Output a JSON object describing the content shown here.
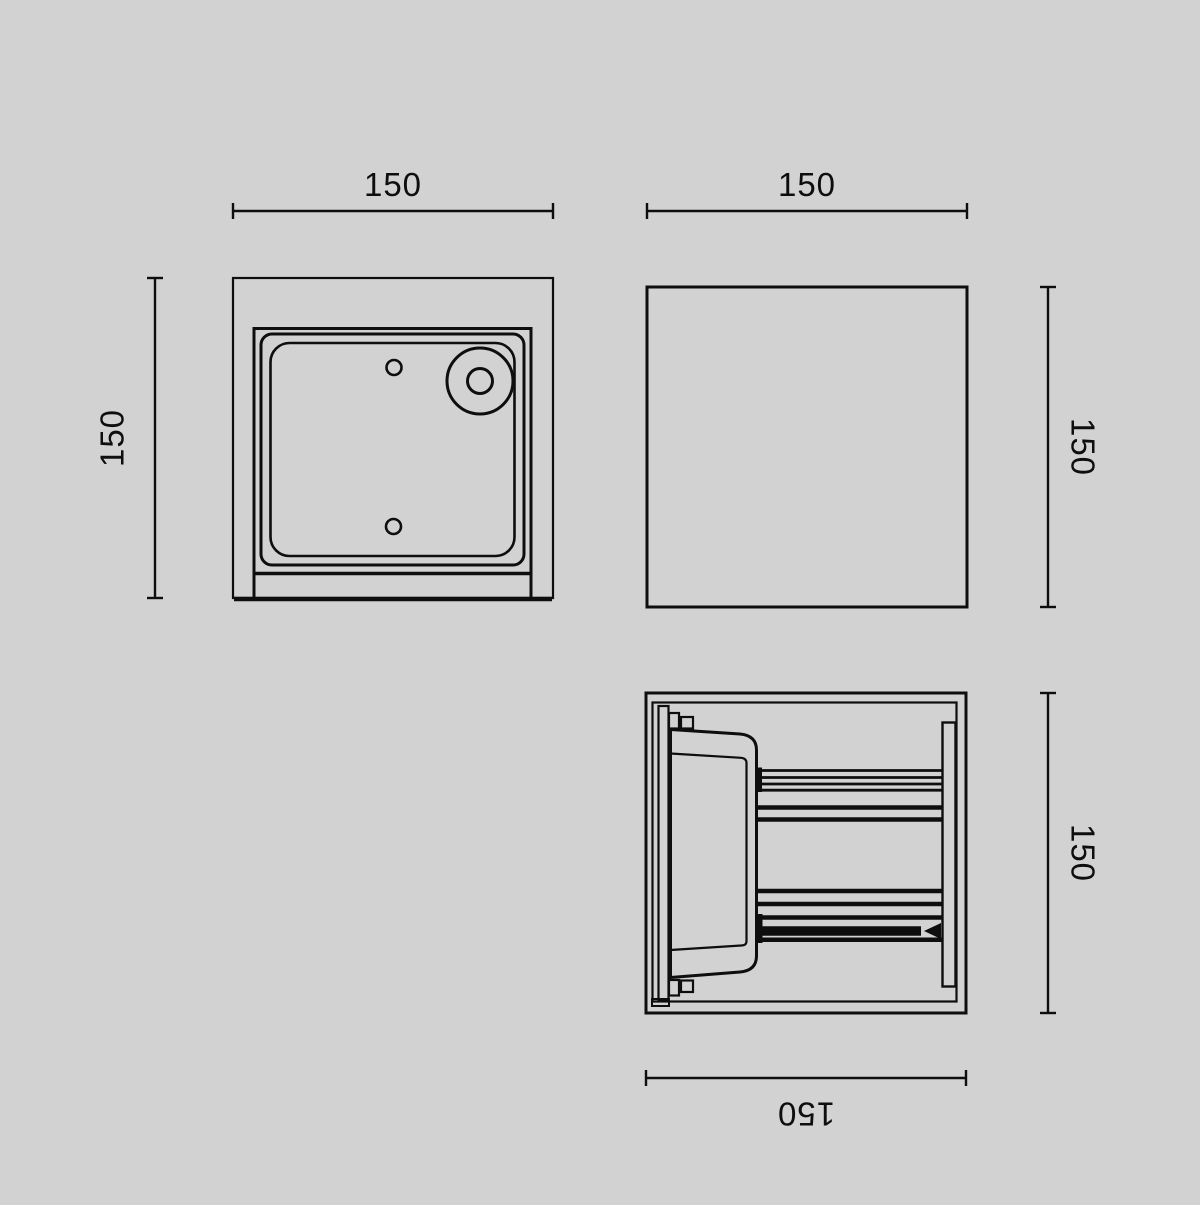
{
  "colors": {
    "background": "#d2d2d2",
    "line": "#0e0e0e"
  },
  "drawing": {
    "type": "technical-dimension-drawing",
    "views": {
      "front_view": {
        "horizontal_dimension": "150",
        "vertical_dimension": "150"
      },
      "side_view": {
        "horizontal_dimension": "150",
        "vertical_dimension": "150"
      },
      "top_view": {
        "horizontal_dimension": "150",
        "vertical_dimension": "150"
      }
    }
  }
}
